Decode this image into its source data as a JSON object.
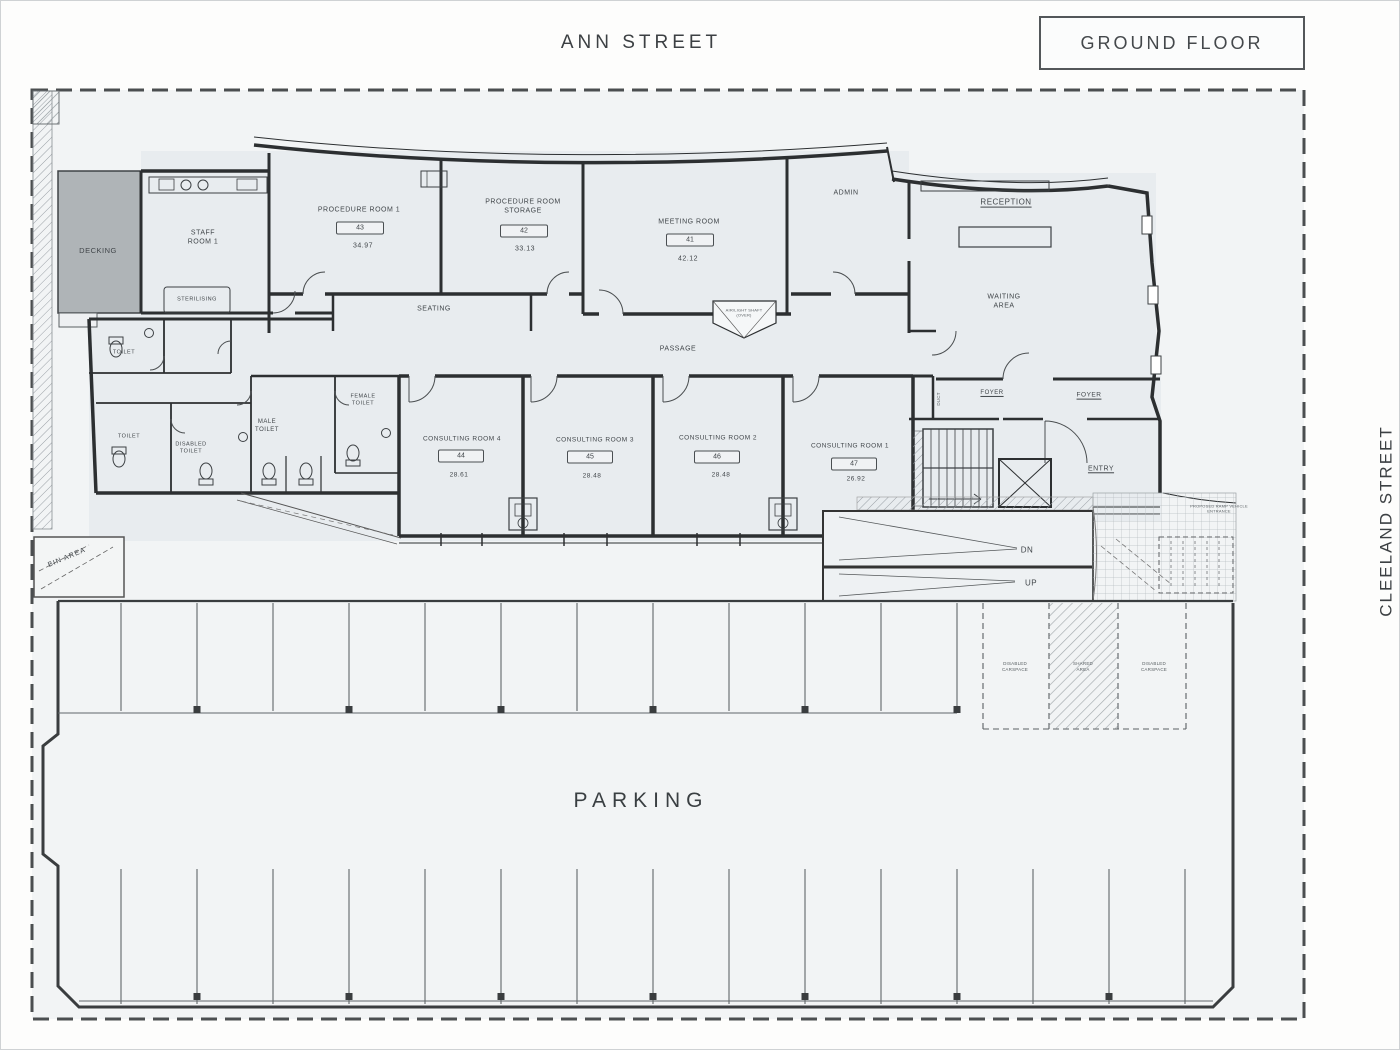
{
  "sheet": {
    "street_top": "ANN STREET",
    "street_right": "CLEELAND STREET",
    "floor_label": "GROUND FLOOR",
    "parking": "PARKING"
  },
  "colors": {
    "decking_fill": "#afb4b7",
    "paper": "#f2f4f5",
    "wall": "#2c2f31"
  },
  "rooms": {
    "decking": {
      "name": "DECKING"
    },
    "staff_room": {
      "name": "STAFF ROOM 1"
    },
    "sterilising": {
      "name": "STERILISING"
    },
    "procedure_room_1": {
      "name": "PROCEDURE ROOM 1",
      "number": "43",
      "area": "34.97"
    },
    "procedure_room_storage": {
      "name": "PROCEDURE ROOM STORAGE",
      "number": "42",
      "area": "33.13"
    },
    "meeting_room": {
      "name": "MEETING ROOM",
      "number": "41",
      "area": "42.12"
    },
    "admin": {
      "name": "ADMIN"
    },
    "reception": {
      "name": "RECEPTION"
    },
    "waiting_area": {
      "name": "WAITING AREA"
    },
    "consulting_room_4": {
      "name": "CONSULTING ROOM 4",
      "number": "44",
      "area": "28.61"
    },
    "consulting_room_3": {
      "name": "CONSULTING ROOM 3",
      "number": "45",
      "area": "28.48"
    },
    "consulting_room_2": {
      "name": "CONSULTING ROOM 2",
      "number": "46",
      "area": "28.48"
    },
    "consulting_room_1": {
      "name": "CONSULTING ROOM 1",
      "number": "47",
      "area": "26.92"
    }
  },
  "labels": {
    "seating": "SEATING",
    "passage": "PASSAGE",
    "toilet_upper": "TOILET",
    "toilet_lower": "TOILET",
    "disabled_toilet": "DISABLED TOILET",
    "male_toilet": "MALE TOILET",
    "female_toilet": "FEMALE TOILET",
    "foyer_left": "FOYER",
    "foyer_right": "FOYER",
    "entry": "ENTRY",
    "stair_dn": "DN",
    "stair_up": "UP",
    "duct": "DUCT",
    "shaft": "AIR/LIGHT SHAFT (OVER)",
    "bin_area": "BIN AREA",
    "ramp_note": "PROPOSED RAMP VEHICLE ENTRANCE",
    "disabled_carspace_left": "DISABLED CARSPACE",
    "shared_area": "SHARED AREA",
    "disabled_carspace_right": "DISABLED CARSPACE"
  }
}
